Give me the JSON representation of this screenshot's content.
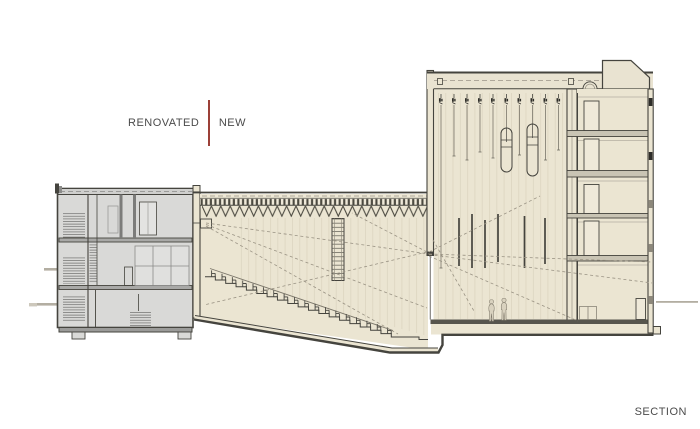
{
  "labels": {
    "renovated": "RENOVATED",
    "new": "NEW",
    "section": "SECTION"
  },
  "colors": {
    "background": "#ffffff",
    "new_construction_fill": "#ebe5d2",
    "renovated_fill": "#d9d9d7",
    "outline_ink": "#45443e",
    "legend_divider_red": "#9c4038",
    "label_text": "#4b4b4b",
    "sightline_dash": "#9a9384"
  },
  "counts": {
    "seat_rows": 18,
    "fly_lines": 10,
    "side_room_levels": 5,
    "stage_figures": 2
  }
}
